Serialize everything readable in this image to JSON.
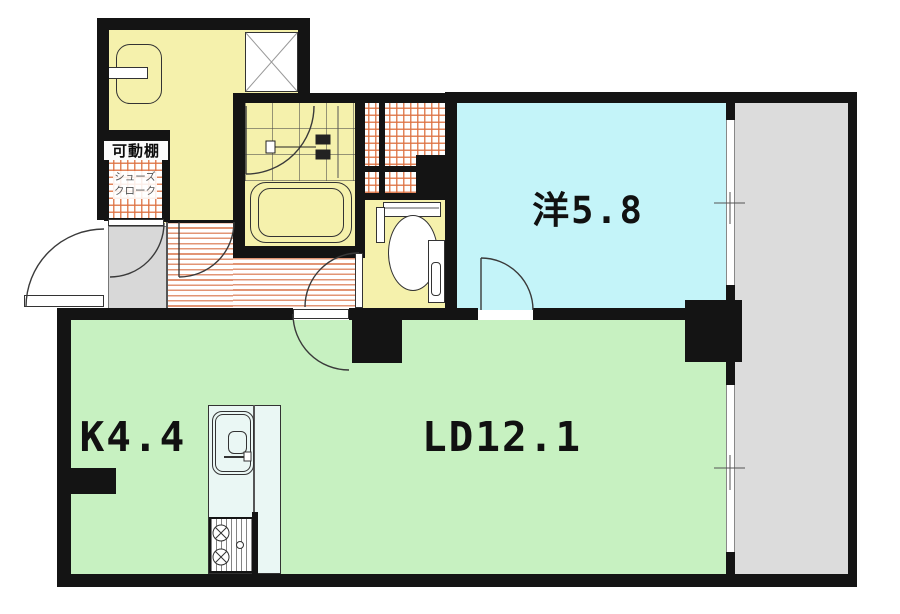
{
  "plan": {
    "rooms": {
      "western_room": {
        "label": "洋5.8"
      },
      "living_dining": {
        "label": "LD12.1"
      },
      "kitchen": {
        "label": "K4.4"
      },
      "movable_shelf": {
        "label": "可動棚"
      },
      "shoes_closet": {
        "label_line1": "シューズ",
        "label_line2": "クローク"
      }
    },
    "colors": {
      "wall": "#141414",
      "western_room_fill": "#c4f4f9",
      "living_dining_fill": "#c7f1c1",
      "sanitary_fill": "#f5f1ac",
      "balcony_fill": "#dcdcdc",
      "entrance_fill": "#d8d8d8",
      "closet_hatch": "#dd7040",
      "hallway_stripe": "#e08f6d",
      "kitchen_counter_fill": "#eaf7f4"
    }
  }
}
